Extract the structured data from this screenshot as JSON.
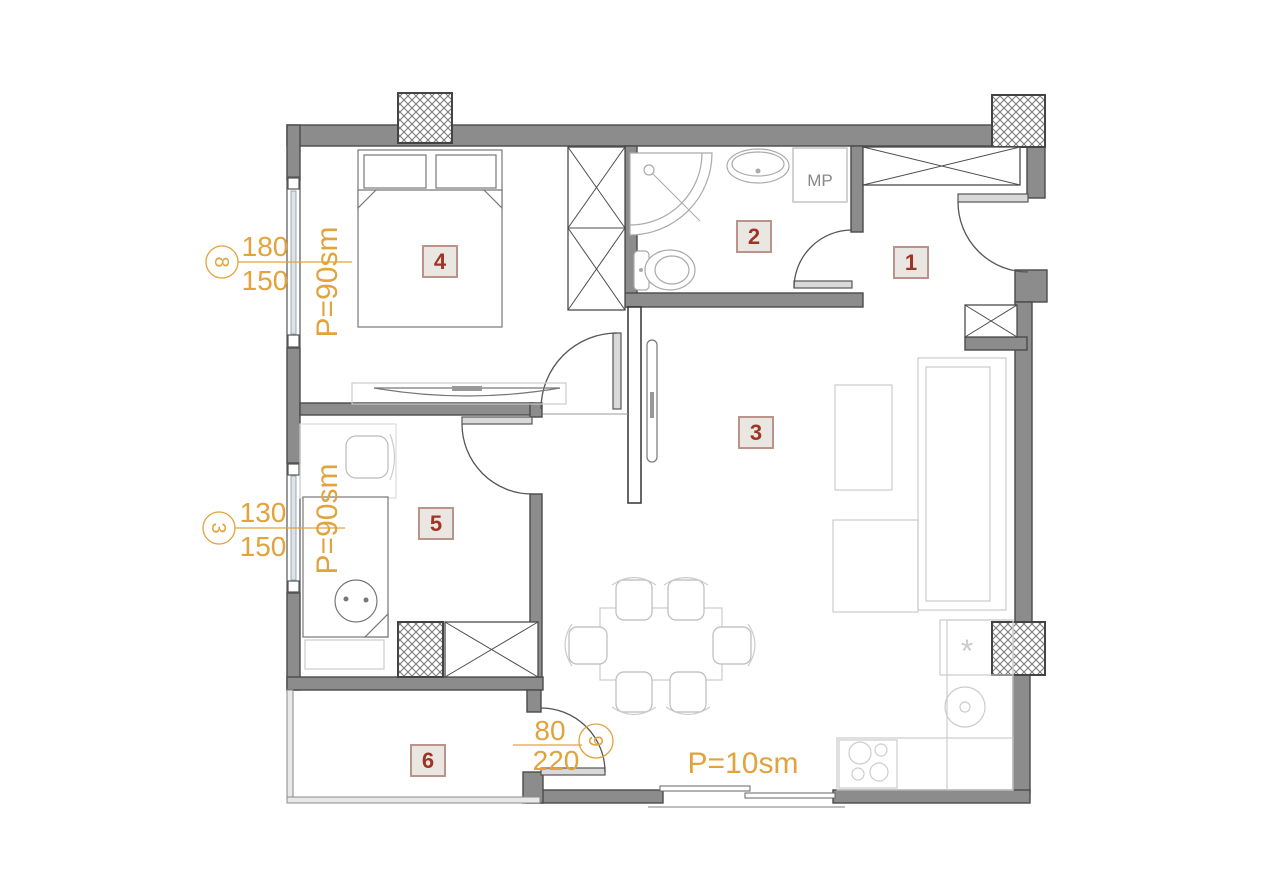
{
  "floor_plan": {
    "rooms": [
      {
        "label": "1"
      },
      {
        "label": "2"
      },
      {
        "label": "3"
      },
      {
        "label": "4"
      },
      {
        "label": "5"
      },
      {
        "label": "6"
      }
    ],
    "area_labels": {
      "bedroom_main": "P=90sm",
      "bedroom_second": "P=90sm",
      "balcony": "P=10sm"
    },
    "window_marks": [
      {
        "bubble": "8",
        "dim_top": "180",
        "dim_bottom": "150"
      },
      {
        "bubble": "3",
        "dim_top": "130",
        "dim_bottom": "150"
      }
    ],
    "door_mark": {
      "bubble": "9",
      "dim_top": "80",
      "dim_bottom": "220"
    },
    "appliances": {
      "washing_machine": "MP",
      "freezer_symbol": "*"
    },
    "colors": {
      "wall": "#8C8C8C",
      "annotation": "#E2A23C",
      "room_number": "#9E3425",
      "badge_fill": "#EAE7E2",
      "badge_border": "#BA938A"
    }
  }
}
